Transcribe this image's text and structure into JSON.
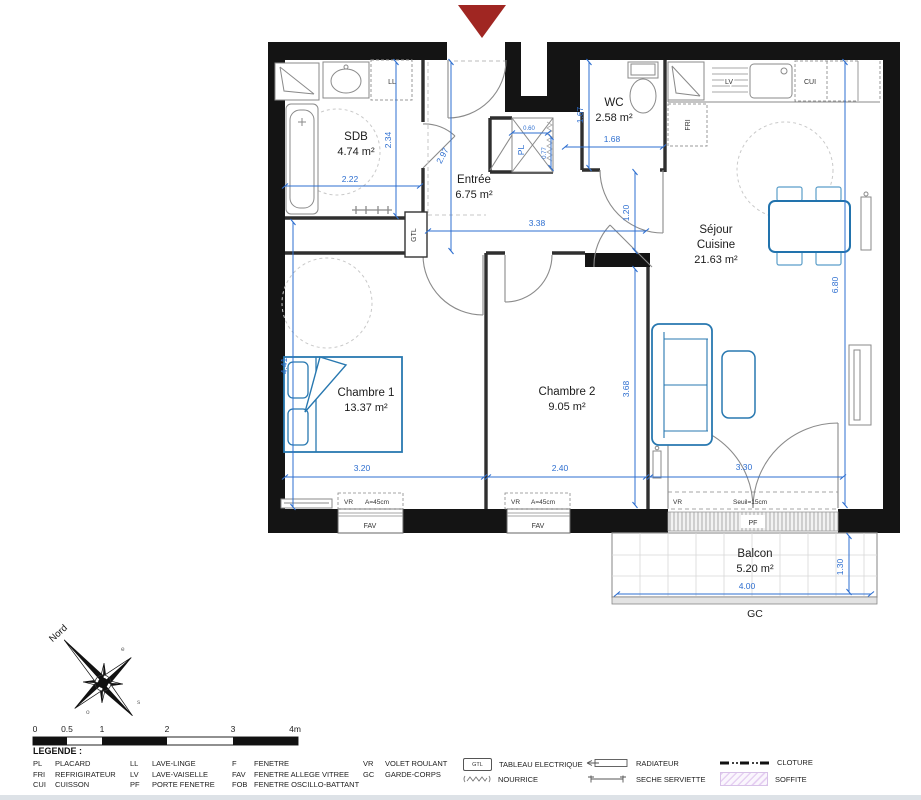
{
  "rooms": {
    "sdb": {
      "name": "SDB",
      "area": "4.74 m²"
    },
    "wc": {
      "name": "WC",
      "area": "2.58 m²"
    },
    "entree": {
      "name": "Entrée",
      "area": "6.75 m²"
    },
    "sejour": {
      "line1": "Séjour",
      "line2": "Cuisine",
      "area": "21.63 m²"
    },
    "chambre1": {
      "name": "Chambre 1",
      "area": "13.37 m²"
    },
    "chambre2": {
      "name": "Chambre 2",
      "area": "9.05 m²"
    },
    "balcon": {
      "name": "Balcon",
      "area": "5.20 m²"
    }
  },
  "dims": {
    "d222": "2.22",
    "d234": "2.34",
    "d297": "2.97",
    "d167": "1.67",
    "d168": "1.68",
    "d120": "1.20",
    "d338": "3.38",
    "d680": "6.80",
    "d441": "4.41",
    "d320": "3.20",
    "d240": "2.40",
    "d368": "3.68",
    "d330": "3.30",
    "d400": "4.00",
    "d130": "1.30",
    "d060": "0.60",
    "d077": "0.77"
  },
  "labels": {
    "ll": "LL",
    "lv": "LV",
    "cui": "CUI",
    "fri": "FRI",
    "gtl": "GTL",
    "pl": "PL",
    "pf": "PF",
    "gc": "GC",
    "fav": "FAV",
    "vr": "VR",
    "a45": "A=45cm",
    "seuil": "Seuil=15cm",
    "nord": "Nord",
    "e": "e",
    "s": "s",
    "o": "o"
  },
  "scalebar": {
    "ticks": [
      "0",
      "0.5",
      "1",
      "2",
      "3",
      "4m"
    ]
  },
  "legend": {
    "title": "LEGENDE :",
    "gtl_icon": "GTL",
    "items": [
      {
        "abbr": "PL",
        "label": "PLACARD"
      },
      {
        "abbr": "FRI",
        "label": "REFRIGIRATEUR"
      },
      {
        "abbr": "CUI",
        "label": "CUISSON"
      },
      {
        "abbr": "LL",
        "label": "LAVE-LINGE"
      },
      {
        "abbr": "LV",
        "label": "LAVE-VAISELLE"
      },
      {
        "abbr": "PF",
        "label": "PORTE FENETRE"
      },
      {
        "abbr": "F",
        "label": "FENETRE"
      },
      {
        "abbr": "FAV",
        "label": "FENETRE ALLEGE VITREE"
      },
      {
        "abbr": "FOB",
        "label": "FENETRE OSCILLO-BATTANT"
      },
      {
        "abbr": "VR",
        "label": "VOLET ROULANT"
      },
      {
        "abbr": "GC",
        "label": "GARDE-CORPS"
      }
    ],
    "symbols": [
      {
        "label": "TABLEAU ELECTRIQUE"
      },
      {
        "label": "NOURRICE"
      },
      {
        "label": "RADIATEUR"
      },
      {
        "label": "SECHE SERVIETTE"
      },
      {
        "label": "CLOTURE"
      },
      {
        "label": "SOFFITE"
      }
    ]
  },
  "colors": {
    "dimension_blue": "#2e6fd0",
    "furniture_blue": "#2878b0",
    "wall_black": "#141414",
    "arrow_red": "#a02622",
    "soffite_purple": "#e6d0f2"
  }
}
